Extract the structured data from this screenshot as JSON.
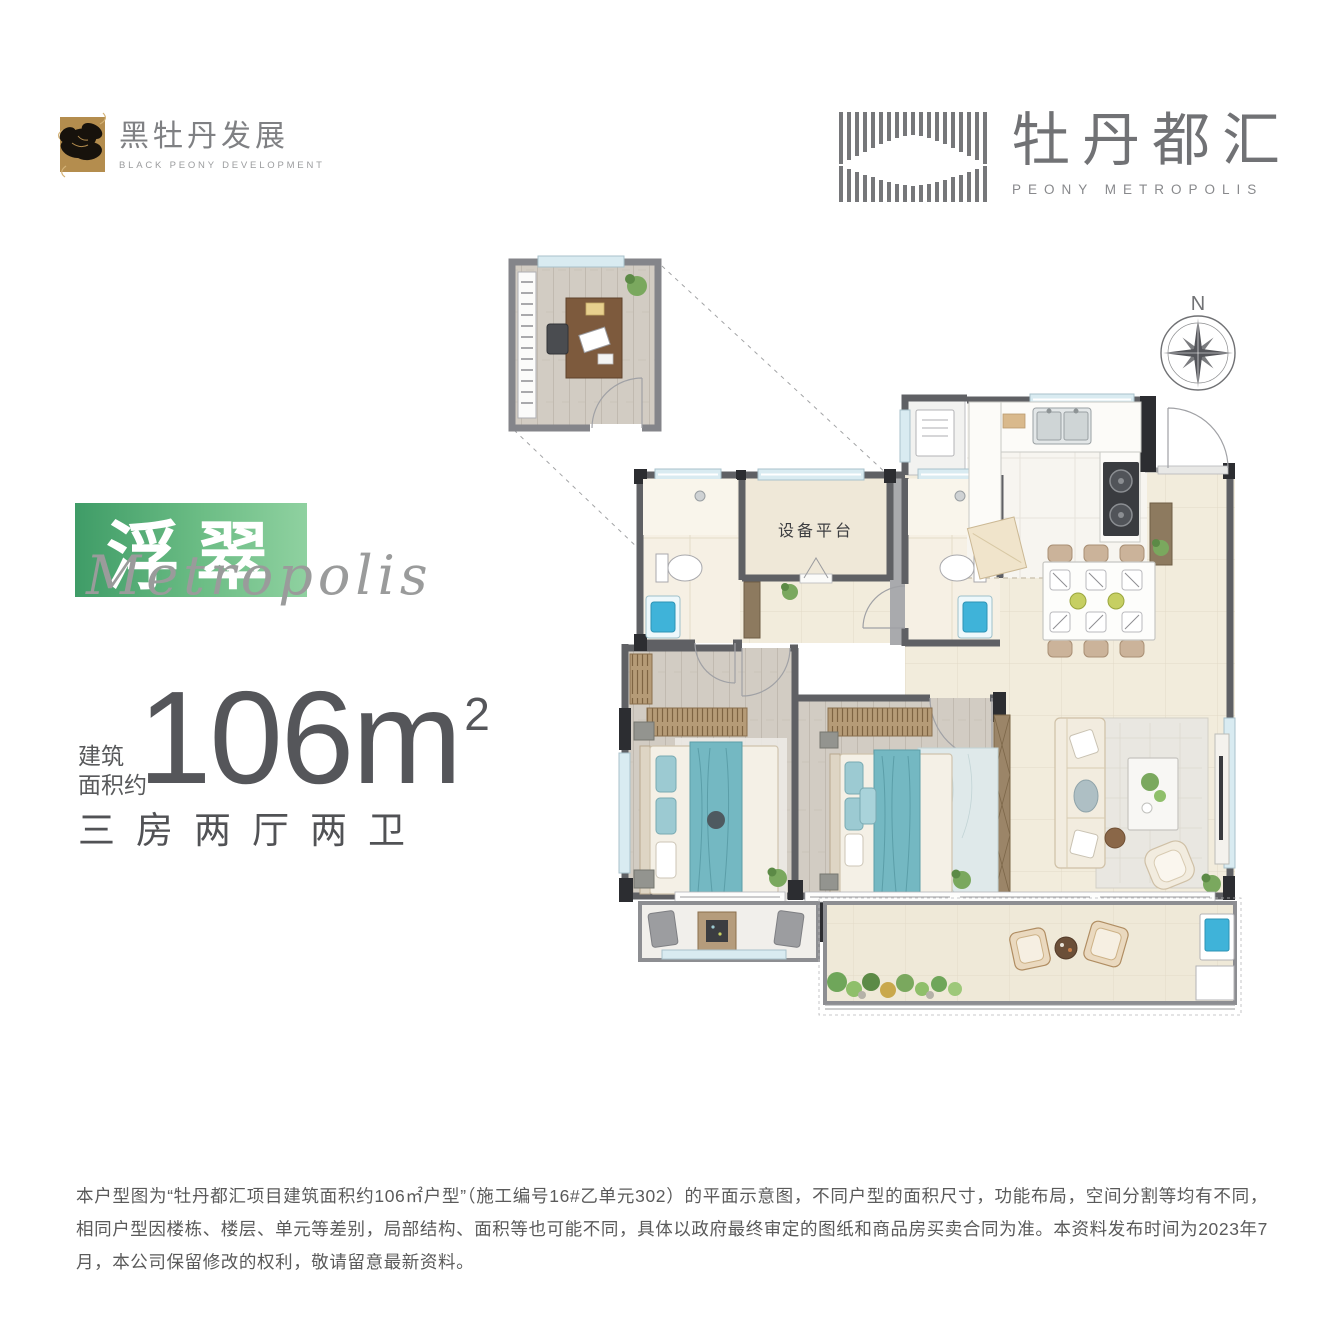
{
  "header": {
    "developer": {
      "cn": "黑牡丹发展",
      "en": "BLACK PEONY DEVELOPMENT"
    },
    "project": {
      "cn": "牡丹都汇",
      "en": "PEONY METROPOLIS"
    }
  },
  "hero": {
    "name_cn": "浮翠",
    "name_script": "Metropolis",
    "area_label_line1": "建筑",
    "area_label_line2": "面积约",
    "area_value": "106",
    "area_unit": "m",
    "area_exponent": "2",
    "layout_text": "三房两厅两卫"
  },
  "floorplan": {
    "platform_label": "设备平台",
    "compass_label": "N"
  },
  "disclaimer": "本户型图为“牡丹都汇项目建筑面积约106㎡户型”（施工编号16#乙单元302）的平面示意图，不同户型的面积尺寸，功能布局，空间分割等均有不同，相同户型因楼栋、楼层、单元等差别，局部结构、面积等也可能不同，具体以政府最终审定的图纸和商品房买卖合同为准。本资料发布时间为2023年7月，本公司保留修改的权利，敬请留意最新资料。",
  "colors": {
    "brand_gold": "#b48d4e",
    "green_dark": "#3f9c67",
    "green_light": "#8fd1a0",
    "bed_teal": "#74b8c2",
    "sink_blue": "#3fb3d9",
    "text_primary": "#58595b",
    "wall_dark": "#2c2d31",
    "wall_gray": "#5f6064"
  }
}
